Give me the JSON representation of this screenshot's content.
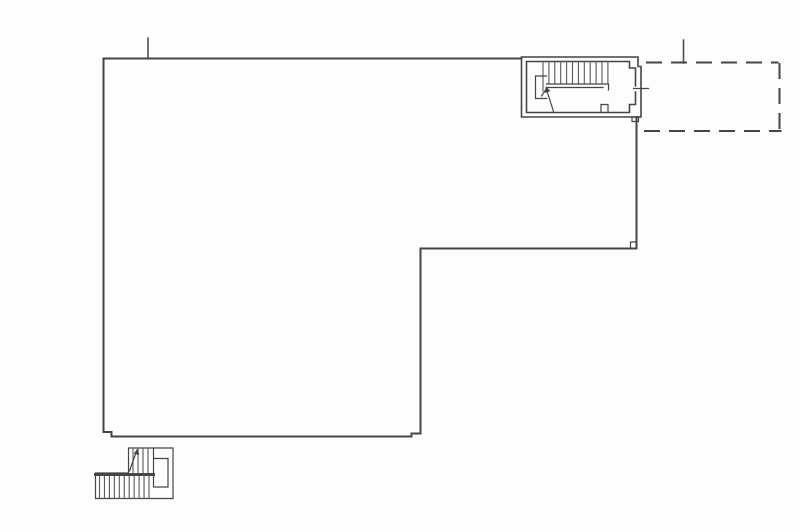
{
  "meta": {
    "type": "architectural-floor-plan",
    "visible_text": "none"
  },
  "palette": {
    "background": "#fdfdfd",
    "line": "#454545",
    "line_light": "#585858"
  },
  "floor_plan": {
    "paths": {
      "main_outline": "M521.5,58.5 H103.5 V432 H111.5 V436.5 H411.5 V433.5 H420.5 V248.5 H636.5 V117",
      "inner_corner_notch": "M636.5,242 H630.5 V248.5",
      "stair_room_outer_wall": "M521.5,57 H638 V66.5 H641 V117 H521.5 Z",
      "stair_room_inner_wall": "M635.5,86 V68 H629.5 V61.5 H526.5 V112.5 H629.5 V104.5 H635.5 V92",
      "stair_room_foot": "M632,117 H638.5 V121.5 H632 Z",
      "stair_room_bottom_notch": "M601,112.5 V104.5 H608 V112.5",
      "stair_room_window_tick": "M633.5,88.5 H648.5",
      "stair_room_treads": "M543,61.5V84M548.9,61.5V84M554.8,61.5V84M560.7,61.5V84M566.6,61.5V84M572.5,61.5V84M578.4,61.5V84M584.3,61.5V84M590.2,61.5V84M596.1,61.5V84M602,61.5V84M607.9,61.5V84M543,84V91",
      "stair_room_handrail": "M546.5,84 H608.5 V90 M546.5,87.5 H603",
      "stair_room_return": "M546.5,76 H535.5 V98.5 H546.5",
      "stair_room_arrow": "M553.5,111.5 L546.3,89 M546.3,89 L541.5,96",
      "stair_room_arrowhead": "M545.8,86.3 L550.4,91.1 L544.8,92.9 Z",
      "dashed_extension": "M647,62.5 H777.5 M779.5,64 V130 M645,131 H780.5",
      "tick_left": "M148,38 V58.5",
      "tick_right": "M683.5,40 V63",
      "ext_stair_outline": "M128.5,448 H173 V498.5 H95.5 V473 H128.5 Z",
      "ext_stair_inner": "M153.5,448 V458.5 M153.5,458.5 H168 V487 H153.5 Z",
      "ext_stair_band": "M95.5,474.5 H153.5",
      "ext_stair_treads_lower": "M99.5,476.5V498.5M104.45,476.5V498.5M109.4,476.5V498.5M114.35,476.5V498.5M119.3,476.5V498.5M124.25,476.5V498.5M129.2,476.5V498.5M134.15,476.5V498.5M139.1,476.5V498.5M144.05,476.5V498.5M149,476.5V498.5",
      "ext_stair_treads_upper": "M133,448V473M138,448V473M143,448V473M148,448V473",
      "ext_stair_arrow": "M129.5,471 L133,461 L137,450",
      "ext_stair_arrowhead": "M138,448.5 L139.2,455.1 L133.6,453.5 Z"
    }
  }
}
